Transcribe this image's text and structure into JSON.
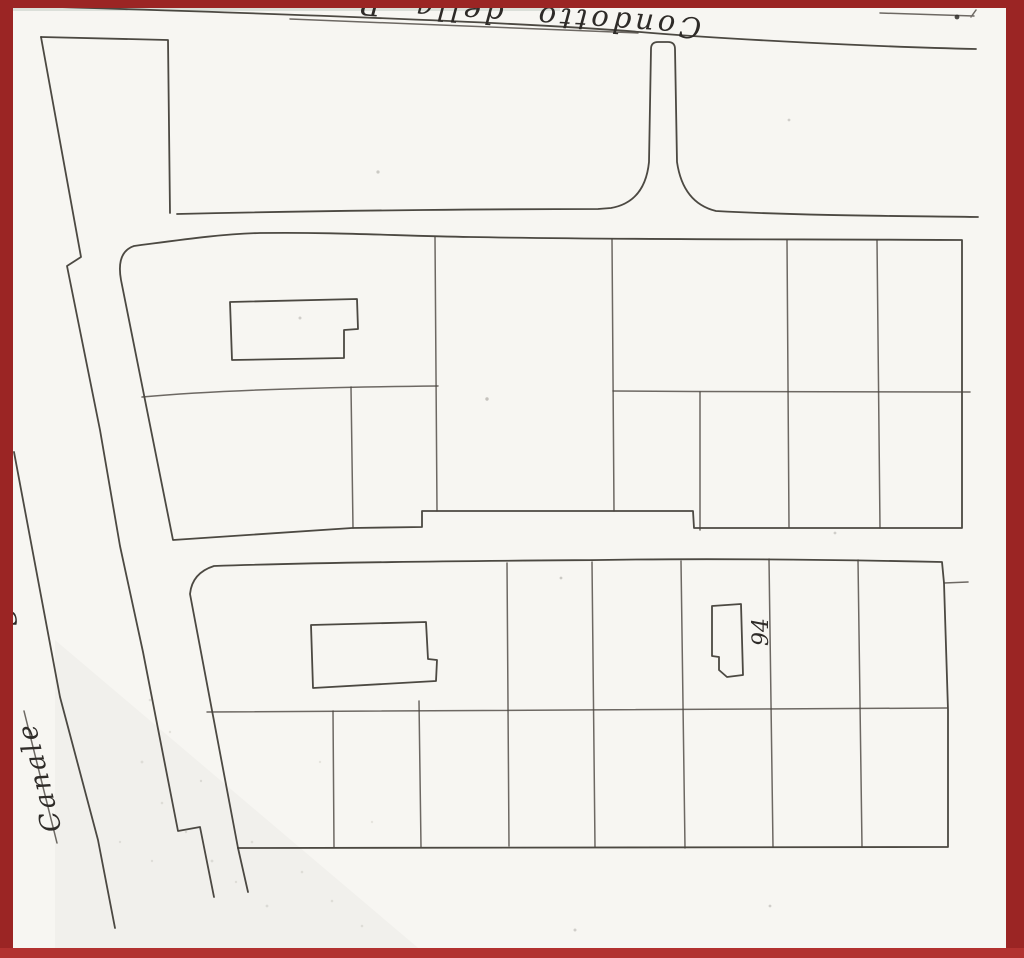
{
  "meta": {
    "border_color": "#9b2524",
    "bottom_border_color": "#b23230",
    "ink_color": "#3d3933",
    "paper_color": "#f7f6f2"
  },
  "labels": {
    "top_road": "Condotto della P",
    "canal": "Canale",
    "parcel_number": "94",
    "edge_fragment": "S"
  }
}
